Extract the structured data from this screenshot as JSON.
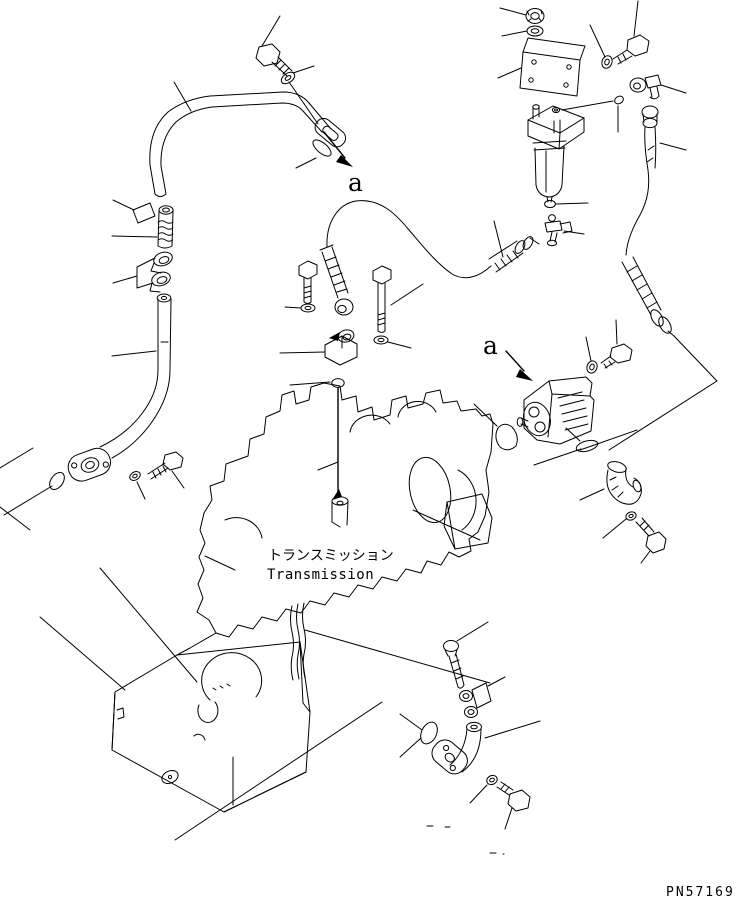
{
  "page": {
    "background_color": "#ffffff",
    "line_color": "#000000"
  },
  "labels": {
    "view_arrow_top": "a",
    "view_arrow_side": "a",
    "component_jp": "トランスミッション",
    "component_en": "Transmission",
    "part_number": "PN57169"
  }
}
